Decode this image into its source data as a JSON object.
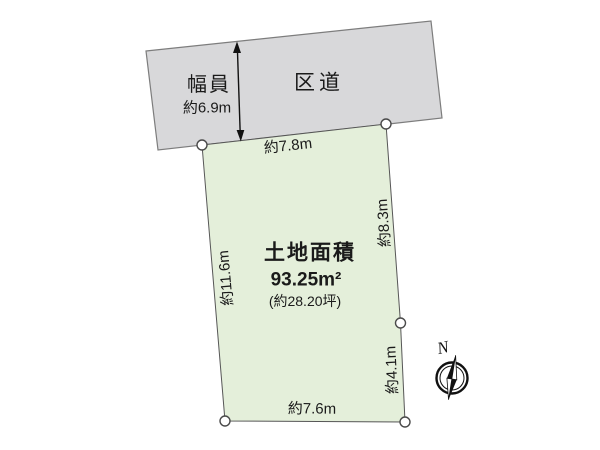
{
  "road": {
    "name": "区道",
    "width_title": "幅員",
    "width_value": "約6.9m"
  },
  "plot": {
    "area_title": "土地面積",
    "area_sqm": "93.25m²",
    "area_tsubo": "(約28.20坪)",
    "dim_top": "約7.8m",
    "dim_right_upper": "約8.3m",
    "dim_right_lower": "約4.1m",
    "dim_bottom": "約7.6m",
    "dim_left": "約11.6m"
  },
  "compass": {
    "north": "N"
  },
  "colors": {
    "road_fill": "#d8d8da",
    "plot_fill": "#e4efda",
    "road_stroke": "#7d7d7d",
    "plot_stroke": "#565656",
    "text": "#1a1a1a"
  }
}
